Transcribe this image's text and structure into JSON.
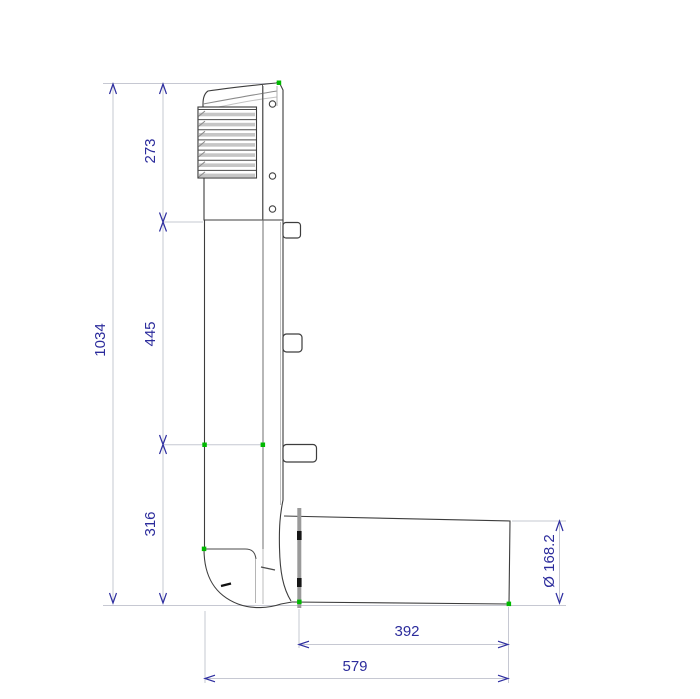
{
  "page": {
    "background_color": "#ffffff",
    "description": "CAD dimension drawing of a roof vent exhaust pipe with louvered cap and elbow outlet, side view"
  },
  "dimensions": {
    "total_height": "1034",
    "section_top": "273",
    "section_middle": "445",
    "section_bottom": "316",
    "outlet_length": "392",
    "overall_width": "579",
    "outlet_diameter": "Ø 168.2"
  },
  "style": {
    "dimension_text_color": "#2c2c9c",
    "arrow_color": "#2e2ea0",
    "extension_line_color": "#c6c8d2",
    "outline_color": "#3d3d3d",
    "marker_color": "#00b800",
    "louver_fill": "#c6c6c6",
    "flange_fill": "#9a9a9a"
  }
}
